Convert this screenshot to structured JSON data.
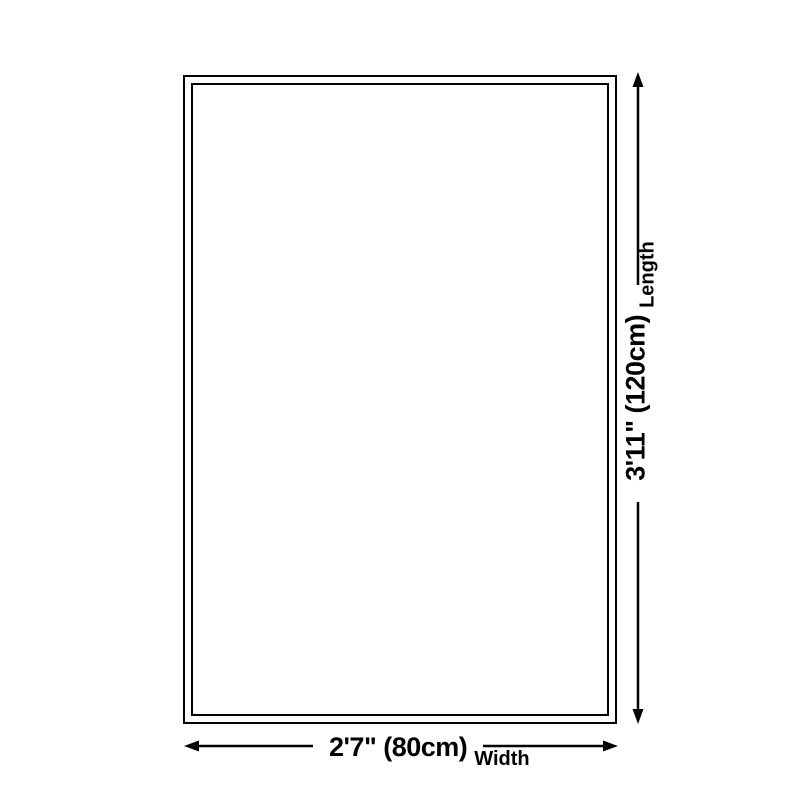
{
  "diagram": {
    "background_color": "#ffffff",
    "line_color": "#000000",
    "text_color": "#000000",
    "length": {
      "value": "3'11\" (120cm)",
      "label": "Length"
    },
    "width": {
      "value": "2'7\" (80cm)",
      "label": "Width"
    }
  }
}
